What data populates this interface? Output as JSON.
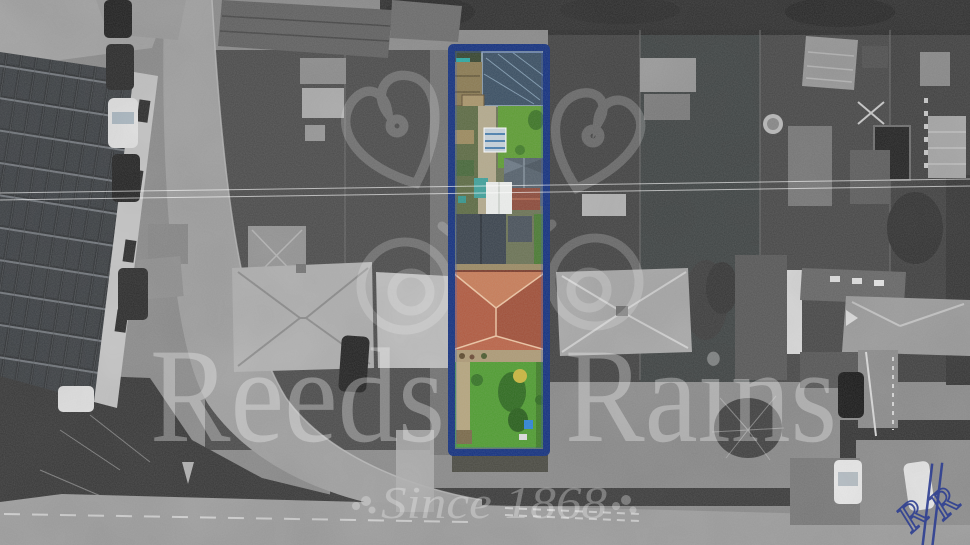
{
  "photo": {
    "type": "aerial-drone-photograph",
    "treatment": "black-and-white scene with one property plot shown in full colour",
    "scene": "residential street with long rear gardens, solar-panel industrial roof top-left, road junction lower-left, houses and driveways right"
  },
  "highlight": {
    "label": "highlighted property plot",
    "border_color": "#14317f",
    "border_inner_color": "#3a5cc0",
    "plot_contents": "greenhouse and vegetable beds at top, sheds and white canopy mid, slate-roof outbuilding, terracotta hipped-roof house, long green lawn"
  },
  "palette": {
    "lawn_green": "#4f9c31",
    "roof_terracotta": "#b05a40",
    "greenhouse_slate": "#3a4f63",
    "teal_shed": "#3fa09a",
    "blue_bin": "#2e84d6"
  },
  "watermark": {
    "brand": "Reeds Rains",
    "brand_word1": "Reeds",
    "brand_word2": "Rains",
    "tagline": "Since 1868",
    "text_color": "#ffffff",
    "text_opacity": "0.32",
    "emblem": "oak-leaf and acorn line emblem"
  },
  "monogram": {
    "name": "Reeds Rains script monogram",
    "color": "#2e3f92"
  }
}
